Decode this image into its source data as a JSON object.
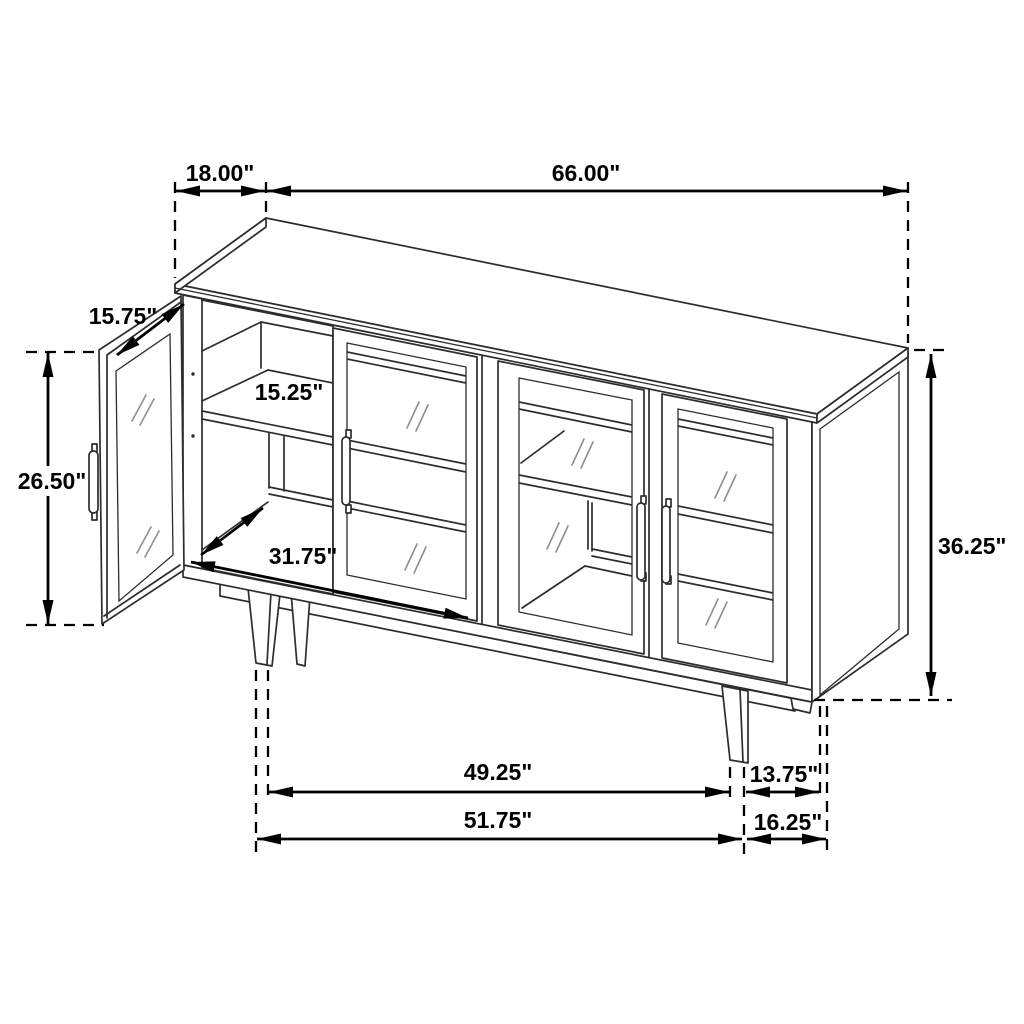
{
  "diagram": {
    "type": "furniture-dimension-line-drawing",
    "subject": "sideboard-cabinet-with-glass-doors-one-door-open",
    "colors": {
      "background": "#ffffff",
      "drawing_line": "#2d2d2d",
      "dimension_line": "#000000",
      "glass_hatch": "#8f8f8f"
    },
    "dimensions": {
      "top_depth": "18.00\"",
      "top_width": "66.00\"",
      "door_width": "15.75\"",
      "door_height": "26.50\"",
      "interior_depth": "15.25\"",
      "interior_width": "31.75\"",
      "overall_height": "36.25\"",
      "inner_leg_span": "49.25\"",
      "side_depth_upper": "13.75\"",
      "outer_leg_span": "51.75\"",
      "side_depth_lower": "16.25\""
    }
  }
}
